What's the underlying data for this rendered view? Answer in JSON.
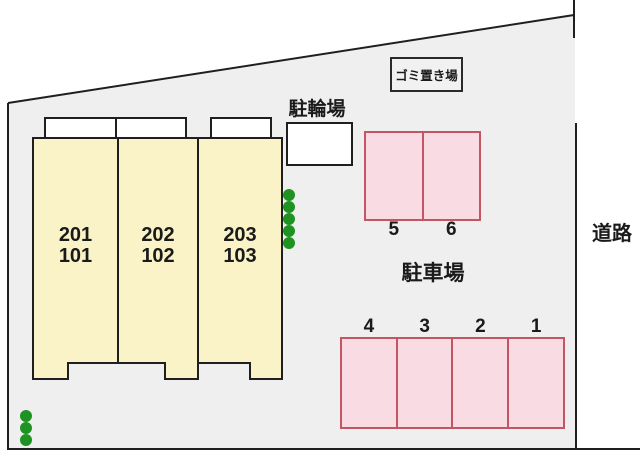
{
  "colors": {
    "outside_fill": "#FFFFFF",
    "plot_fill": "#EFEFEF",
    "outline": "#1F1F1F",
    "building_fill": "#FAF3C8",
    "balcony_fill": "#FFFFFF",
    "bicycle_area_fill": "#FFFFFF",
    "garbage_box_fill": "#F1F1F1",
    "parking_fill": "#F9DBE4",
    "parking_border": "#C25663",
    "tree": "#1E9322",
    "text": "#1A1A1A"
  },
  "labels": {
    "garbage_area": "ゴミ置き場",
    "bicycle_parking": "駐輪場",
    "parking_lot": "駐車場",
    "road": "道路"
  },
  "building": {
    "units": [
      {
        "upper": "201",
        "lower": "101"
      },
      {
        "upper": "202",
        "lower": "102"
      },
      {
        "upper": "203",
        "lower": "103"
      }
    ]
  },
  "parking": {
    "upper_row_stalls": [
      "5",
      "6"
    ],
    "lower_row_stalls": [
      "4",
      "3",
      "2",
      "1"
    ]
  },
  "landscaping": {
    "trees_right_of_building": 5,
    "trees_bottom_left": 3
  }
}
